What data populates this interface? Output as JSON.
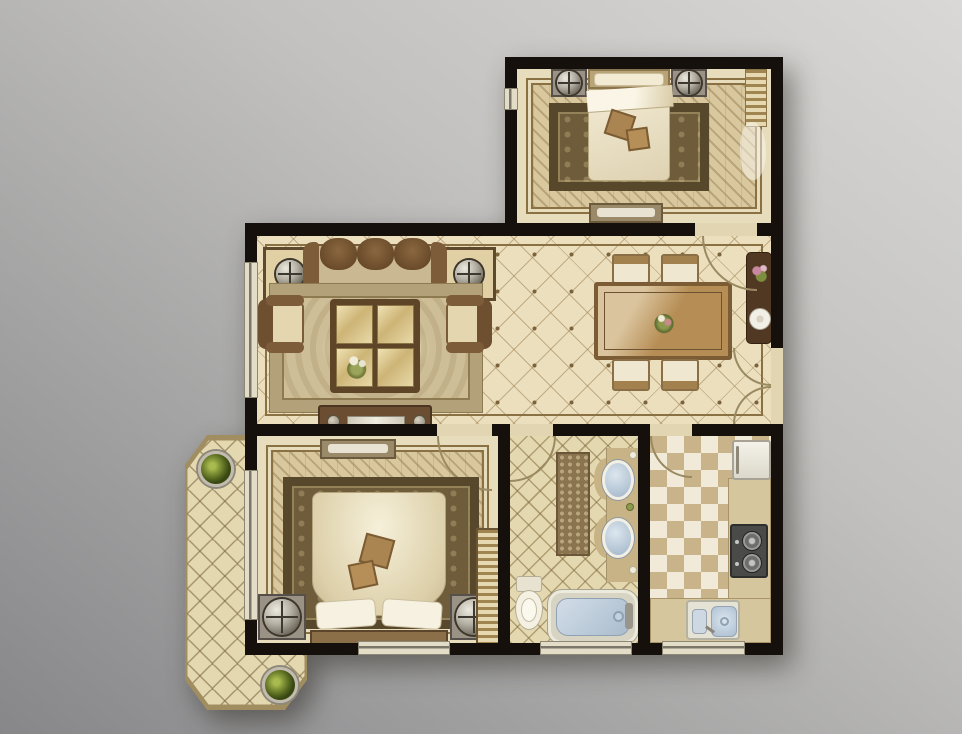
{
  "meta": {
    "type": "residential floor plan",
    "view": "top-down interior rendering",
    "backdrop": "gray studio gradient, lighter at top-right",
    "visible_text": "none"
  },
  "palette": {
    "wall": "#15100b",
    "floor-cream": "#ecdfbd",
    "floor-wood": "#d9c89e",
    "tile-beige": "#e4d8b0",
    "wood-dark": "#5c4229",
    "wood-mid": "#8a6a46",
    "wood-light": "#c9ad7c",
    "fabric-cream": "#f2ead3",
    "rug-dark": "#6e5c3a",
    "rug-border": "#57472b",
    "water-blue": "#aabfd4",
    "metal": "#b5b0a4",
    "plant-green": "#7d8f34",
    "counter-tan": "#d6c69e",
    "trim": "#8a7144"
  },
  "rooms": [
    {
      "id": "second-bedroom",
      "label": "second bedroom (top right)",
      "floor": "herringbone wood with beige border",
      "furniture": [
        "double bed with headboard at top",
        "two nightstands with round lamps",
        "dark ornate area rug",
        "bench at foot wall",
        "window curtain along right wall"
      ]
    },
    {
      "id": "living-room",
      "label": "living room (center left)",
      "floor": "cream diamond-grid tile with dot inlays",
      "furniture": [
        "three-seat brown sofa",
        "two corner end tables with sphere lamps",
        "left armchair",
        "right armchair",
        "ornate light area rug",
        "four-panel glass coffee table with flower centerpiece",
        "tv console on south wall"
      ]
    },
    {
      "id": "dining-room",
      "label": "dining room (center right)",
      "floor": "cream diamond-grid tile with dot inlays",
      "furniture": [
        "rectangular wood dining table with floral centerpiece",
        "four upholstered chairs",
        "dark sideboard with flowers and display plate",
        "double entry door on right wall"
      ]
    },
    {
      "id": "master-bedroom",
      "label": "master bedroom (bottom left)",
      "floor": "herringbone wood with beige border",
      "furniture": [
        "double bed with headboard at bottom",
        "fluffy duvet with two decorative pillows",
        "two white pillows",
        "two nightstands with round lamps",
        "dark ornate area rug",
        "bench at top wall",
        "wardrobe strip on right side"
      ]
    },
    {
      "id": "bathroom",
      "label": "bathroom (bottom center)",
      "floor": "beige lattice tile",
      "furniture": [
        "double-sink vanity with scalloped counter",
        "brown runner rug",
        "toilet",
        "bathtub with blue water and right-end faucet"
      ]
    },
    {
      "id": "kitchen",
      "label": "kitchen (bottom right)",
      "floor": "checkerboard tile",
      "furniture": [
        "refrigerator top-right",
        "right-side counter",
        "two-burner gas stove",
        "bottom counter",
        "double-basin sink"
      ]
    },
    {
      "id": "balcony",
      "label": "balcony (left, octagonal)",
      "floor": "diagonal lattice tile",
      "furniture": [
        "potted plant at top",
        "potted plant at bottom"
      ]
    }
  ],
  "openings": {
    "doors": [
      {
        "room": "second-bedroom",
        "position": "bottom wall right side, swings into dining"
      },
      {
        "room": "master-bedroom",
        "position": "top wall right side, swings into bedroom"
      },
      {
        "room": "bathroom",
        "position": "top wall left side, swings into bathroom"
      },
      {
        "room": "kitchen",
        "position": "top wall left side, swings into kitchen"
      },
      {
        "room": "entry",
        "position": "right wall of dining, double doors swinging inward"
      }
    ],
    "windows": [
      {
        "room": "living-room",
        "position": "left wall"
      },
      {
        "room": "master-bedroom",
        "position": "left wall and bottom wall"
      },
      {
        "room": "bathroom",
        "position": "bottom wall"
      },
      {
        "room": "kitchen",
        "position": "bottom wall"
      },
      {
        "room": "second-bedroom",
        "position": "left wall small"
      }
    ]
  },
  "counts": {
    "rooms": 7,
    "plants": 2,
    "lamps": 6,
    "beds": 2,
    "sinks": 3,
    "chairs": 4
  }
}
